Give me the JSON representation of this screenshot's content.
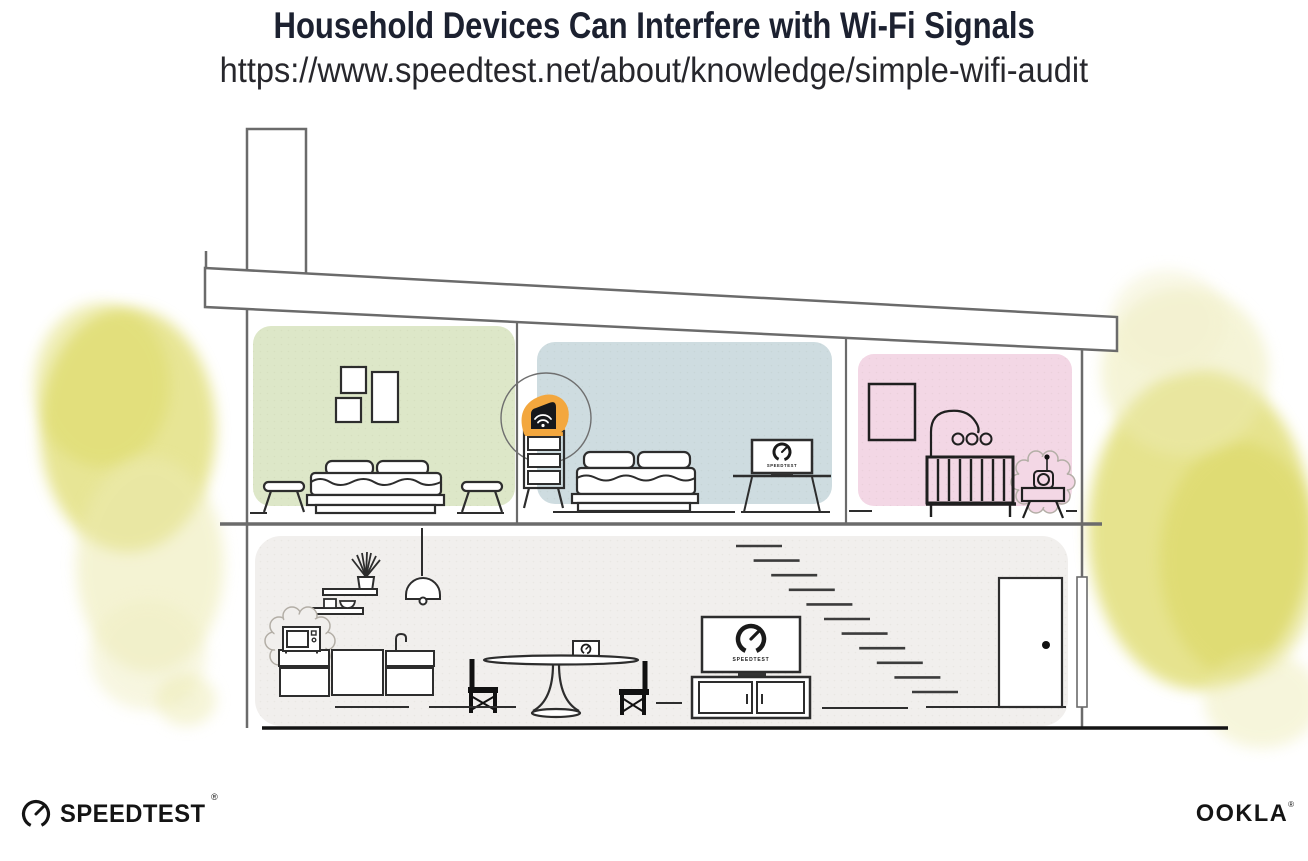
{
  "header": {
    "title": "Household Devices Can Interfere with Wi-Fi Signals",
    "subtitle_url": "https://www.speedtest.net/about/knowledge/simple-wifi-audit"
  },
  "illustration": {
    "screens": {
      "bedroom_laptop_brand": "SPEEDTEST",
      "living_room_tv_brand": "SPEEDTEST"
    },
    "colors": {
      "bedroom_left_wall": "#dde7c8",
      "bedroom_middle_wall": "#cedce0",
      "nursery_wall": "#f3d7e5",
      "router_highlight": "#f3a73e",
      "foliage": "#e0dd72",
      "lower_floor": "#f1efed"
    }
  },
  "footer": {
    "speedtest_wordmark": "SPEEDTEST",
    "speedtest_registered": "®",
    "ookla_wordmark": "OOKLA",
    "ookla_registered": "®"
  }
}
